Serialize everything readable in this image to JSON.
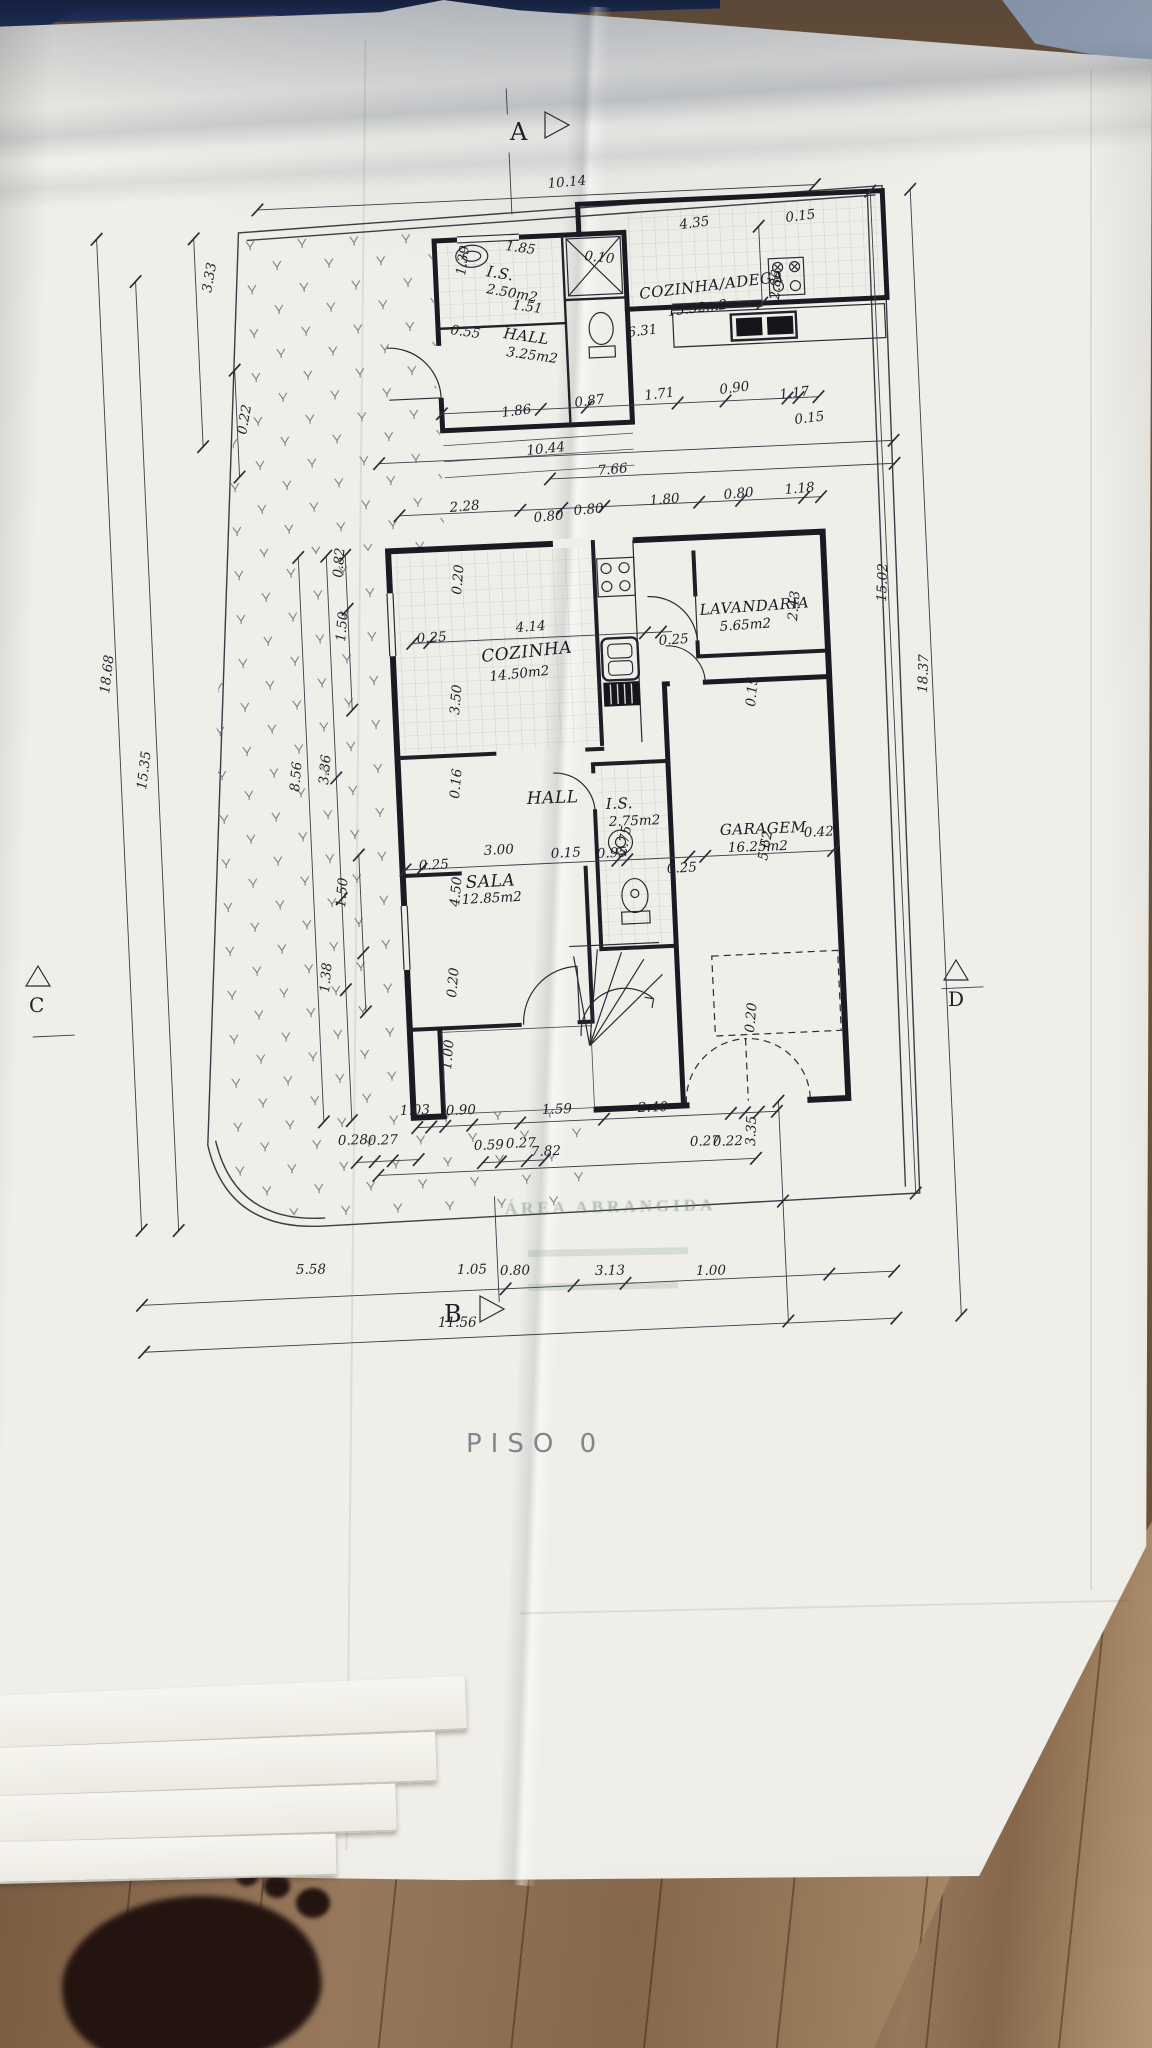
{
  "document": {
    "floor_title": "PISO 0",
    "stamp_text": "ÁREA ABRANGIDA"
  },
  "sections": {
    "a": "A",
    "b": "B",
    "c": "C",
    "d": "D",
    "b_total": "11.56"
  },
  "rooms": [
    {
      "name": "I.S.",
      "area": "2.50m2"
    },
    {
      "name": "HALL",
      "area": "3.25m2"
    },
    {
      "name": "COZINHA/ADEGA",
      "area": "15.52m2"
    },
    {
      "name": "COZINHA",
      "area": "14.50m2"
    },
    {
      "name": "LAVANDARIA",
      "area": "5.65m2"
    },
    {
      "name": "HALL",
      "area": ""
    },
    {
      "name": "I.S.",
      "area": "2.75m2"
    },
    {
      "name": "GARAGEM",
      "area": "16.25m2"
    },
    {
      "name": "SALA",
      "area": "12.85m2"
    }
  ],
  "dimensions": [
    {
      "t": "10.14",
      "x": 548,
      "y": 188,
      "r": -5
    },
    {
      "t": "0.10",
      "x": 584,
      "y": 260,
      "r": 6
    },
    {
      "t": "1.85",
      "x": 505,
      "y": 250,
      "r": 8
    },
    {
      "t": "1.39",
      "x": 465,
      "y": 276,
      "r": -82
    },
    {
      "t": "1.51",
      "x": 512,
      "y": 309,
      "r": 8
    },
    {
      "t": "0.55",
      "x": 450,
      "y": 334,
      "r": 8
    },
    {
      "t": "4.35",
      "x": 680,
      "y": 229,
      "r": -7
    },
    {
      "t": "0.15",
      "x": 786,
      "y": 222,
      "r": -7
    },
    {
      "t": "2.86",
      "x": 779,
      "y": 300,
      "r": -86
    },
    {
      "t": "6.31",
      "x": 628,
      "y": 337,
      "r": -7
    },
    {
      "t": "1.86",
      "x": 502,
      "y": 417,
      "r": -7
    },
    {
      "t": "0.87",
      "x": 575,
      "y": 407,
      "r": -7
    },
    {
      "t": "1.71",
      "x": 645,
      "y": 400,
      "r": -7
    },
    {
      "t": "0.90",
      "x": 720,
      "y": 394,
      "r": -7
    },
    {
      "t": "1.17",
      "x": 780,
      "y": 399,
      "r": -7
    },
    {
      "t": "0.15",
      "x": 795,
      "y": 424,
      "r": -7
    },
    {
      "t": "10.44",
      "x": 527,
      "y": 455,
      "r": -6
    },
    {
      "t": "7.66",
      "x": 598,
      "y": 475,
      "r": -5
    },
    {
      "t": "2.28",
      "x": 450,
      "y": 512,
      "r": -5
    },
    {
      "t": "0.80",
      "x": 534,
      "y": 522,
      "r": -5
    },
    {
      "t": "0.80",
      "x": 574,
      "y": 515,
      "r": -5
    },
    {
      "t": "1.80",
      "x": 650,
      "y": 505,
      "r": -5
    },
    {
      "t": "0.80",
      "x": 724,
      "y": 499,
      "r": -5
    },
    {
      "t": "1.18",
      "x": 785,
      "y": 494,
      "r": -5
    },
    {
      "t": "0.82",
      "x": 342,
      "y": 578,
      "r": -85
    },
    {
      "t": "1.50",
      "x": 345,
      "y": 642,
      "r": -85
    },
    {
      "t": "0.20",
      "x": 461,
      "y": 595,
      "r": -85
    },
    {
      "t": "4.14",
      "x": 516,
      "y": 632,
      "r": -4
    },
    {
      "t": "0.25",
      "x": 417,
      "y": 643,
      "r": -4
    },
    {
      "t": "3.50",
      "x": 459,
      "y": 715,
      "r": -85
    },
    {
      "t": "0.25",
      "x": 659,
      "y": 645,
      "r": -4
    },
    {
      "t": "2.43",
      "x": 797,
      "y": 621,
      "r": -85
    },
    {
      "t": "0.15",
      "x": 755,
      "y": 707,
      "r": -85
    },
    {
      "t": "0.16",
      "x": 459,
      "y": 799,
      "r": -85
    },
    {
      "t": "2.75",
      "x": 626,
      "y": 856,
      "r": -80
    },
    {
      "t": "0.95",
      "x": 597,
      "y": 858,
      "r": -3
    },
    {
      "t": "5.62",
      "x": 767,
      "y": 861,
      "r": -80
    },
    {
      "t": "0.42",
      "x": 804,
      "y": 837,
      "r": -3
    },
    {
      "t": "3.00",
      "x": 484,
      "y": 855,
      "r": -3
    },
    {
      "t": "0.15",
      "x": 551,
      "y": 858,
      "r": -3
    },
    {
      "t": "0.25",
      "x": 419,
      "y": 870,
      "r": -3
    },
    {
      "t": "0.25",
      "x": 667,
      "y": 873,
      "r": -3
    },
    {
      "t": "4.50",
      "x": 459,
      "y": 907,
      "r": -85
    },
    {
      "t": "0.20",
      "x": 456,
      "y": 998,
      "r": -85
    },
    {
      "t": "1.00",
      "x": 451,
      "y": 1070,
      "r": -85
    },
    {
      "t": "0.20",
      "x": 754,
      "y": 1033,
      "r": -85
    },
    {
      "t": "1.38",
      "x": 329,
      "y": 993,
      "r": -85
    },
    {
      "t": "1.50",
      "x": 345,
      "y": 908,
      "r": -85
    },
    {
      "t": "3.36",
      "x": 328,
      "y": 785,
      "r": -85
    },
    {
      "t": "8.56",
      "x": 299,
      "y": 792,
      "r": -85
    },
    {
      "t": "15.35",
      "x": 146,
      "y": 790,
      "r": -83
    },
    {
      "t": "18.68",
      "x": 109,
      "y": 694,
      "r": -83
    },
    {
      "t": "3.33",
      "x": 211,
      "y": 293,
      "r": -80
    },
    {
      "t": "0.22",
      "x": 246,
      "y": 435,
      "r": -80
    },
    {
      "t": "15.02",
      "x": 886,
      "y": 602,
      "r": -88
    },
    {
      "t": "18.37",
      "x": 927,
      "y": 693,
      "r": -88
    },
    {
      "t": "3.35",
      "x": 755,
      "y": 1146,
      "r": -88
    },
    {
      "t": "1.03",
      "x": 400,
      "y": 1115,
      "r": -2
    },
    {
      "t": "0.90",
      "x": 446,
      "y": 1115,
      "r": -2
    },
    {
      "t": "1.59",
      "x": 542,
      "y": 1114,
      "r": -2
    },
    {
      "t": "2.40",
      "x": 638,
      "y": 1112,
      "r": -2
    },
    {
      "t": "0.28",
      "x": 338,
      "y": 1145,
      "r": -2
    },
    {
      "t": "0.27",
      "x": 368,
      "y": 1145,
      "r": -2
    },
    {
      "t": "0.59",
      "x": 474,
      "y": 1150,
      "r": -2
    },
    {
      "t": "0.27",
      "x": 506,
      "y": 1148,
      "r": -2
    },
    {
      "t": "7.82",
      "x": 531,
      "y": 1156,
      "r": -2
    },
    {
      "t": "0.27",
      "x": 690,
      "y": 1146,
      "r": -2
    },
    {
      "t": "0.22",
      "x": 713,
      "y": 1146,
      "r": -2
    },
    {
      "t": "5.58",
      "x": 296,
      "y": 1274,
      "r": -1
    },
    {
      "t": "1.05",
      "x": 457,
      "y": 1274,
      "r": -1
    },
    {
      "t": "0.80",
      "x": 500,
      "y": 1275,
      "r": -1
    },
    {
      "t": "3.13",
      "x": 595,
      "y": 1275,
      "r": -1
    },
    {
      "t": "1.00",
      "x": 696,
      "y": 1275,
      "r": -1
    }
  ],
  "colors": {
    "paper": "#efeee8",
    "ink": "#1a1a22",
    "navy_background": "#1c2c50",
    "wood_floor": "#8f7052",
    "stamp_green": "#588060"
  }
}
